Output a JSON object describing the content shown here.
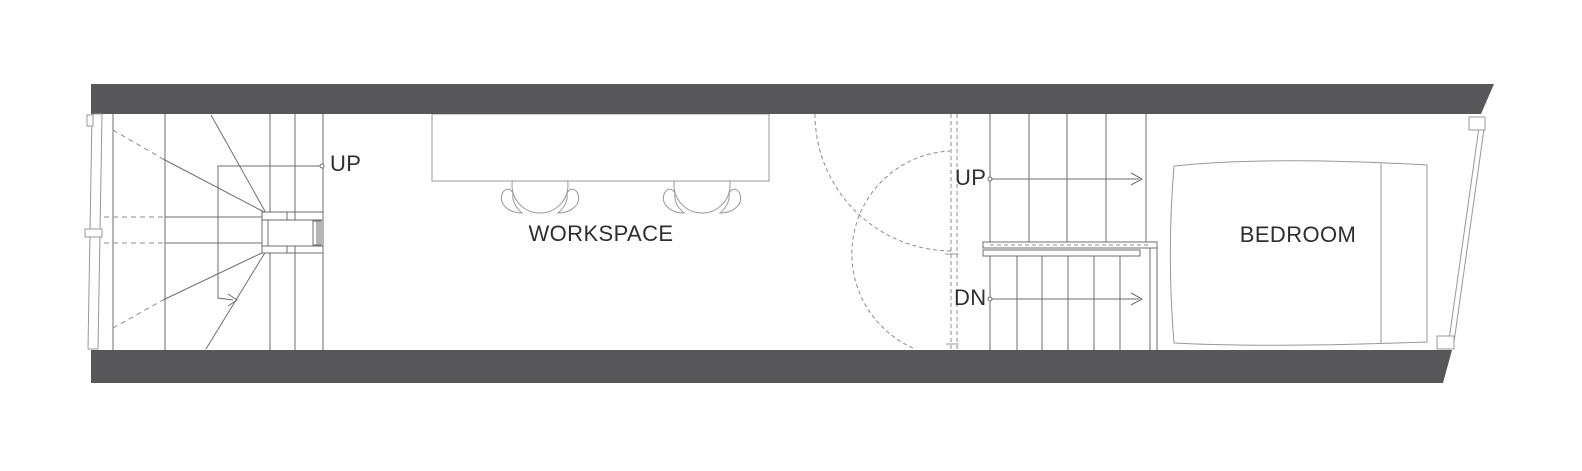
{
  "plan_title": "Narrow apartment floor plan - workspace level",
  "colors": {
    "background": "#ffffff",
    "wall": "#57575a",
    "line_dark": "#6e6e71",
    "line_light": "#98989b",
    "dashed": "#8d8d90",
    "text": "#2e2e2e"
  },
  "labels": {
    "left_stair_up": "UP",
    "workspace": "WORKSPACE",
    "right_stair_up": "UP",
    "right_stair_dn": "DN",
    "bedroom": "BEDROOM"
  },
  "elements": {
    "rooms": [
      "WORKSPACE",
      "BEDROOM"
    ],
    "stairs": [
      "winder-stair-left",
      "straight-stair-right"
    ],
    "furniture": [
      "desk",
      "chair",
      "chair",
      "bed"
    ],
    "direction_markers": [
      "UP",
      "UP",
      "DN"
    ]
  }
}
